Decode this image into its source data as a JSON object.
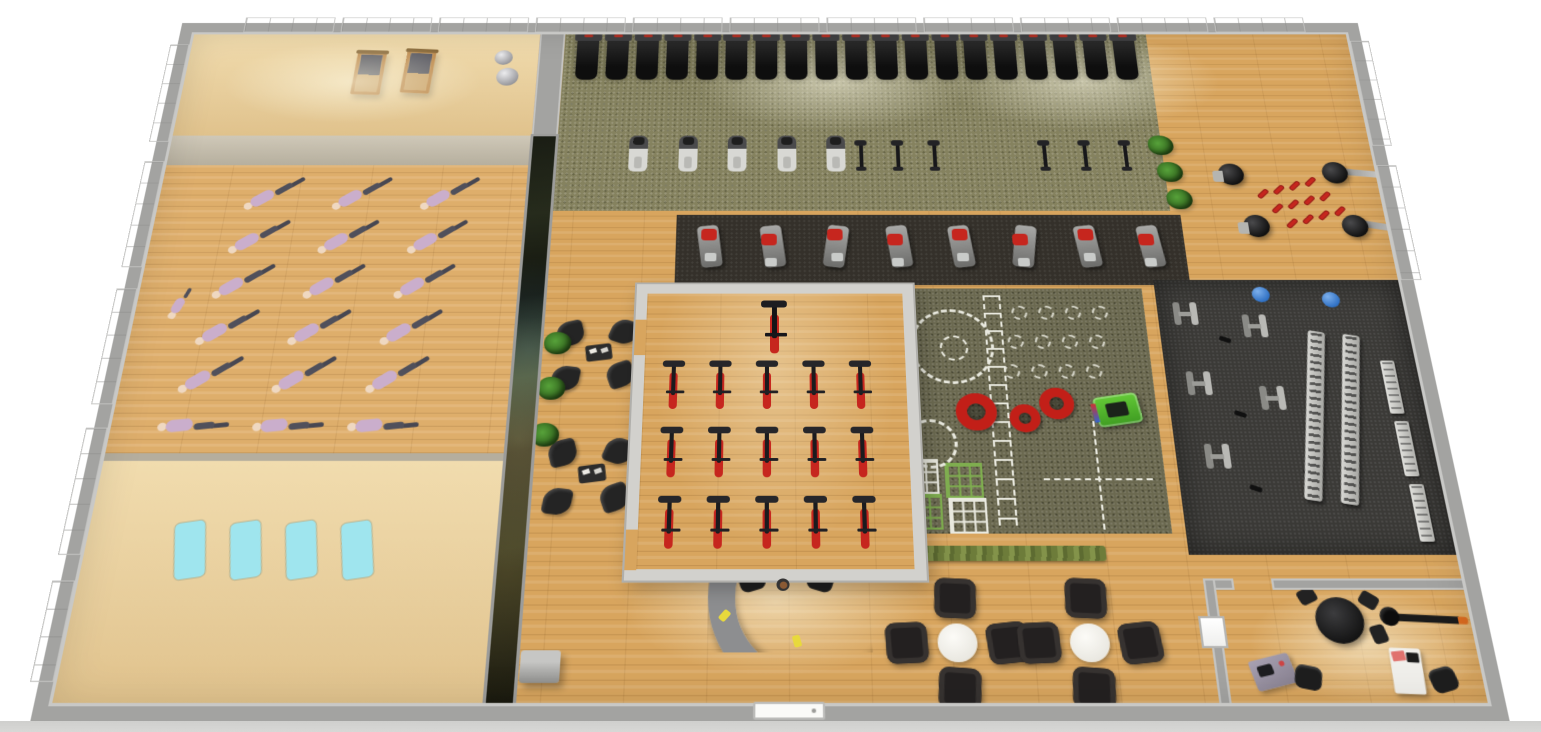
{
  "scene": {
    "view": "perspective-top-down-render"
  },
  "palette": {
    "wood": "#d8a55e",
    "wood-line": "#b07c36",
    "beige": "#ecd2a2",
    "carpet": "#85825f",
    "turf": "#6b6950",
    "mat-dark": "#34302a",
    "mat-black": "#3b3a37",
    "wall": "#a3a3a1",
    "wall-light": "#d2d1cd",
    "red": "#c6261e",
    "green": "#4fb32b",
    "cyan": "#9fe5ee",
    "blue": "#2e6fc2",
    "plant": "#3e7d2b",
    "lilac": "#c2a5c5",
    "hedge": "#75853f",
    "desk-gray": "#8d8e90"
  },
  "zones": {
    "pilates_corner": {
      "label": "pilates-towers-corner",
      "towers": 2,
      "exercise_balls": 2
    },
    "group_fitness_studio": {
      "label": "group-fitness-studio",
      "participant_rows": 6,
      "participants_per_row": 3,
      "participants": 18,
      "instructors": 1
    },
    "stretch_mat_area": {
      "label": "mat-area",
      "mats": 4
    },
    "mural_wall": {
      "label": "mural-partition-wall",
      "panels": 1
    },
    "cardio_zone": {
      "label": "cardio-zone",
      "treadmills": 19,
      "ellipticals": 5,
      "exercise_bikes": 6,
      "plants": 3
    },
    "boxing_corner": {
      "label": "boxing-corner",
      "free_standing_bags": 2,
      "wall_mounted_bags": 2,
      "floor_dumbbells": 12
    },
    "strength_machine_row": {
      "label": "strength-machine-row",
      "machines": 8
    },
    "spin_studio": {
      "label": "spin-studio",
      "bike_rows": 3,
      "bikes_per_row": 5,
      "class_bikes": 15,
      "instructor_bikes": 1,
      "door_openings": 2
    },
    "lounge": {
      "label": "lounge-chairs",
      "clusters": 2,
      "chairs_per_cluster": 4,
      "side_tables": 2,
      "plants": 3
    },
    "functional_turf": {
      "label": "functional-training-turf",
      "tires": 3,
      "sleds": 1,
      "agility_grids": 4,
      "marked_circles": 14
    },
    "free_weights": {
      "label": "free-weights-zone",
      "benches": 5,
      "dumbbell_racks": 2,
      "wall_racks": 3,
      "stability_balls": 2,
      "loose_dumbbells": 4
    },
    "reception": {
      "label": "reception",
      "desks": 1,
      "staff": 1,
      "task_chairs": 2,
      "plants": 1,
      "kiosks": 1,
      "yellow_items": 2
    },
    "cafe_seating": {
      "label": "cafe-seating",
      "clusters": 2,
      "armchairs_per_cluster": 4,
      "round_tables": 2,
      "hedge_planters": 1
    },
    "office": {
      "label": "office",
      "meeting_tables": 1,
      "meeting_chairs": 3,
      "desks": 2,
      "desk_chairs": 2,
      "rowing_machines": 1,
      "wall_windows": 1
    },
    "entrance": {
      "label": "entrance-door",
      "doors": 1
    },
    "windows": {
      "left_wall": 5,
      "top_wall": 11,
      "right_wall": 2
    }
  }
}
